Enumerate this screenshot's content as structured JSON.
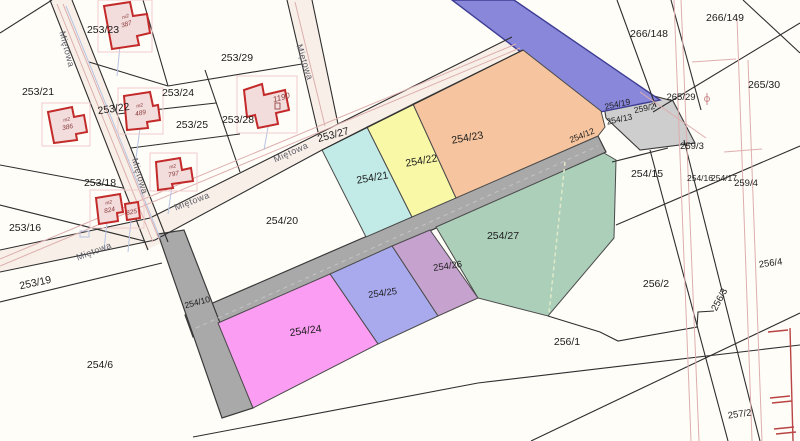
{
  "map_title": "Cadastral parcel map",
  "street": {
    "name": "Miętowa"
  },
  "parcels": [
    {
      "id": "253/21"
    },
    {
      "id": "253/23"
    },
    {
      "id": "253/29"
    },
    {
      "id": "253/22"
    },
    {
      "id": "253/24"
    },
    {
      "id": "253/25"
    },
    {
      "id": "253/28"
    },
    {
      "id": "253/27"
    },
    {
      "id": "253/18"
    },
    {
      "id": "253/16"
    },
    {
      "id": "253/19"
    },
    {
      "id": "254/20"
    },
    {
      "id": "254/6"
    },
    {
      "id": "254/21"
    },
    {
      "id": "254/22"
    },
    {
      "id": "254/23"
    },
    {
      "id": "254/12"
    },
    {
      "id": "254/19"
    },
    {
      "id": "259/2"
    },
    {
      "id": "254/13"
    },
    {
      "id": "265/29"
    },
    {
      "id": "265/30"
    },
    {
      "id": "266/148"
    },
    {
      "id": "266/149"
    },
    {
      "id": "259/3"
    },
    {
      "id": "254/15"
    },
    {
      "id": "254/16"
    },
    {
      "id": "254/17"
    },
    {
      "id": "259/4"
    },
    {
      "id": "256/1"
    },
    {
      "id": "256/2"
    },
    {
      "id": "256/3"
    },
    {
      "id": "256/4"
    },
    {
      "id": "257/2"
    },
    {
      "id": "254/10"
    },
    {
      "id": "254/24"
    },
    {
      "id": "254/25"
    },
    {
      "id": "254/26"
    },
    {
      "id": "254/27"
    }
  ],
  "buildings": [
    {
      "prefix": "m2",
      "number": "387"
    },
    {
      "prefix": "m2",
      "number": "386"
    },
    {
      "prefix": "m2",
      "number": "489"
    },
    {
      "prefix": "",
      "number": "1190"
    },
    {
      "prefix": "m2",
      "number": "824"
    },
    {
      "prefix": "",
      "number": "825"
    },
    {
      "prefix": "m2",
      "number": "797"
    }
  ],
  "colors": {
    "parcel_254_21": "#c2ebe7",
    "parcel_254_22": "#f8f8a6",
    "parcel_254_23": "#f6c49e",
    "parcel_254_24": "#fb9df2",
    "parcel_254_25": "#a9aaee",
    "parcel_254_26": "#c6a2cf",
    "parcel_254_27": "#accfba",
    "road_gray": "#a9a9a9",
    "wedge_gray": "#cecece",
    "utility_purple": "#8987d9",
    "building_red": "#c32a2a",
    "background": "#fffdf8"
  }
}
